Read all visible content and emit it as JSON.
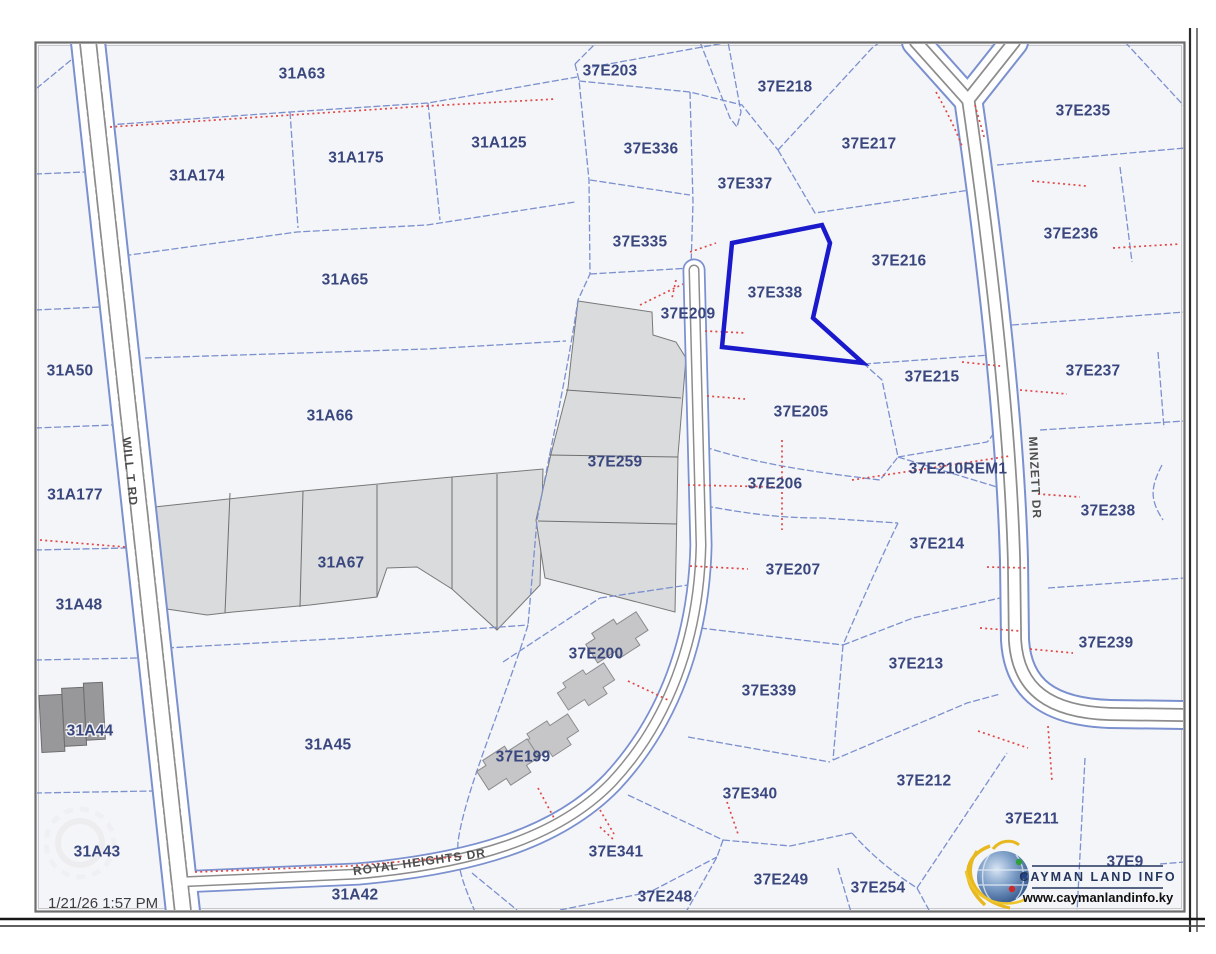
{
  "app": {
    "timestamp": "1/21/26 1:57 PM"
  },
  "branding": {
    "name": "CAYMAN LAND INFO",
    "website": "www.caymanlandinfo.ky"
  },
  "map": {
    "highlighted_parcel": "37E338",
    "roads": [
      {
        "name": "WILL T RD"
      },
      {
        "name": "MINZETT DR"
      },
      {
        "name": "ROYAL HEIGHTS DR"
      }
    ],
    "parcels": [
      {
        "id": "31A63"
      },
      {
        "id": "37E203"
      },
      {
        "id": "37E218"
      },
      {
        "id": "37E235"
      },
      {
        "id": "31A174"
      },
      {
        "id": "31A175"
      },
      {
        "id": "31A125"
      },
      {
        "id": "37E336"
      },
      {
        "id": "37E337"
      },
      {
        "id": "37E217"
      },
      {
        "id": "37E335"
      },
      {
        "id": "37E216"
      },
      {
        "id": "37E236"
      },
      {
        "id": "31A65"
      },
      {
        "id": "37E338"
      },
      {
        "id": "37E209"
      },
      {
        "id": "31A50"
      },
      {
        "id": "37E215"
      },
      {
        "id": "37E237"
      },
      {
        "id": "31A66"
      },
      {
        "id": "37E205"
      },
      {
        "id": "37E210REM1"
      },
      {
        "id": "37E206"
      },
      {
        "id": "31A177"
      },
      {
        "id": "37E259"
      },
      {
        "id": "37E238"
      },
      {
        "id": "37E214"
      },
      {
        "id": "31A67"
      },
      {
        "id": "37E207"
      },
      {
        "id": "31A48"
      },
      {
        "id": "37E239"
      },
      {
        "id": "37E213"
      },
      {
        "id": "37E200"
      },
      {
        "id": "37E339"
      },
      {
        "id": "31A44"
      },
      {
        "id": "31A45"
      },
      {
        "id": "37E199"
      },
      {
        "id": "37E212"
      },
      {
        "id": "37E340"
      },
      {
        "id": "37E211"
      },
      {
        "id": "37E341"
      },
      {
        "id": "37E9"
      },
      {
        "id": "31A43"
      },
      {
        "id": "37E249"
      },
      {
        "id": "37E254"
      },
      {
        "id": "31A42"
      },
      {
        "id": "37E248"
      }
    ]
  },
  "colors": {
    "parcel_line": "#7b90cf",
    "label": "#39477e",
    "highlight": "#1a1acc",
    "red_dotted": "#e04848",
    "section_fill": "#dadbdd",
    "map_background": "#f4f5f8"
  }
}
